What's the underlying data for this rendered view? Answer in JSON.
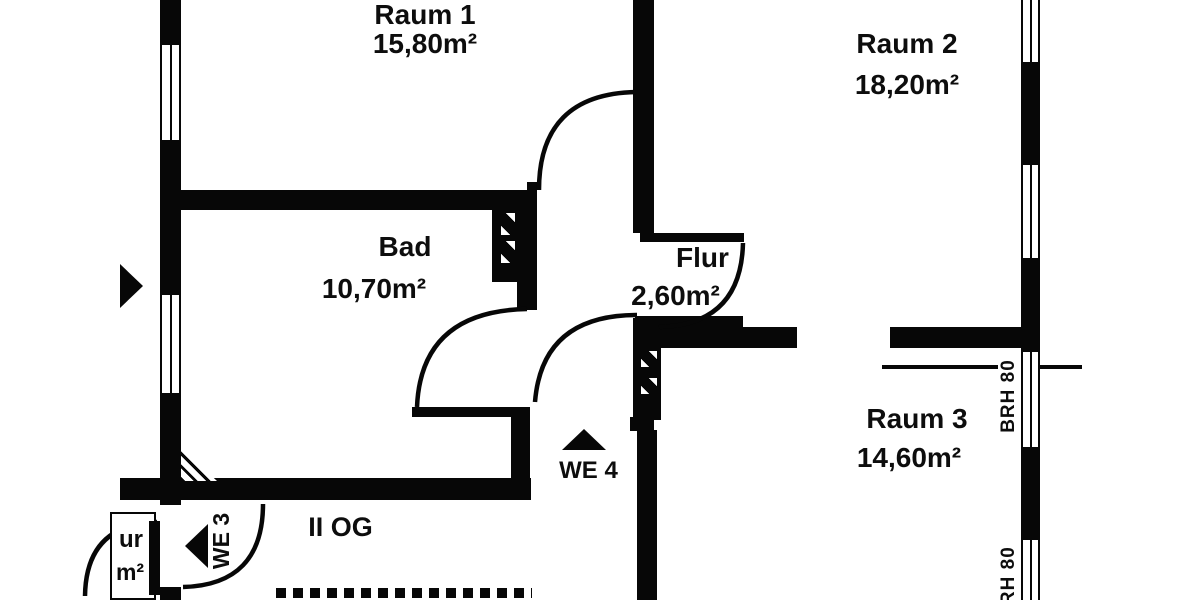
{
  "floorplan": {
    "rooms": [
      {
        "name": "Raum 1",
        "area": "15,80m²"
      },
      {
        "name": "Raum 2",
        "area": "18,20m²"
      },
      {
        "name": "Bad",
        "area": "10,70m²"
      },
      {
        "name": "Flur",
        "area": "2,60m²"
      },
      {
        "name": "Raum 3",
        "area": "14,60m²"
      }
    ],
    "units": {
      "we4": "WE 4",
      "we3": "WE 3"
    },
    "floor_label": "II OG",
    "sill_labels": [
      "BRH 80",
      "BRH 80"
    ],
    "partial_label": {
      "line1": "ur",
      "line2": "m²"
    },
    "colors": {
      "wall": "#070707",
      "background": "#ffffff"
    }
  }
}
